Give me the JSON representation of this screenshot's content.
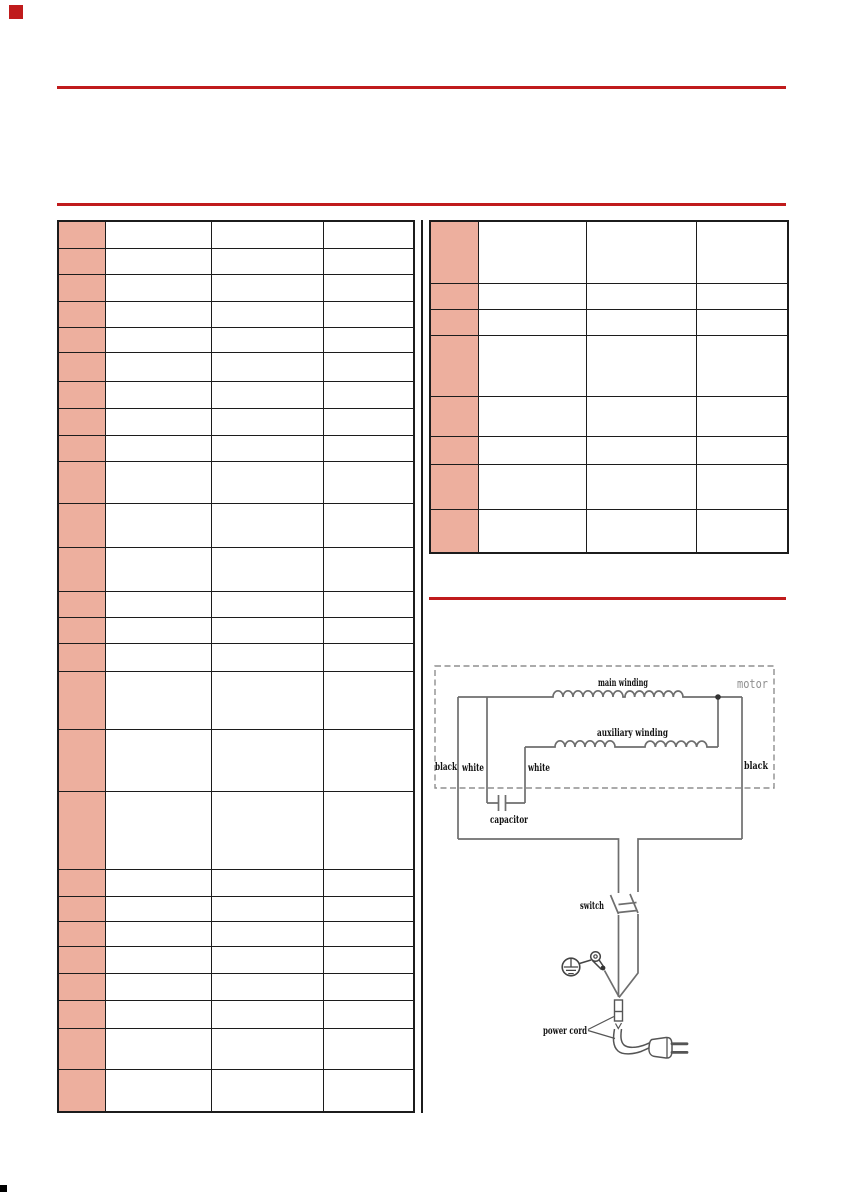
{
  "page": {
    "background": "#ffffff"
  },
  "colors": {
    "accent_red": "#c01b1c",
    "table_pink": "#edaf9e",
    "table_border": "#1c1c1c",
    "wire_gray": "#6e6e6e",
    "label_black": "#111111",
    "motor_gray": "#8f8f8f",
    "corner_mark_black": "#000000"
  },
  "tables": {
    "left": {
      "rows": 26,
      "cols": 4,
      "first_column_highlighted": true,
      "cells_empty": true
    },
    "right": {
      "rows": 8,
      "cols": 4,
      "first_column_highlighted": true,
      "cells_empty": true
    }
  },
  "diagram": {
    "labels": {
      "motor": "motor",
      "main_winding": "main winding",
      "auxiliary_winding": "auxiliary winding",
      "black_left": "black",
      "white_left": "white",
      "white_mid": "white",
      "black_right": "black",
      "capacitor": "capacitor",
      "switch": "switch",
      "power_cord": "power cord"
    }
  }
}
